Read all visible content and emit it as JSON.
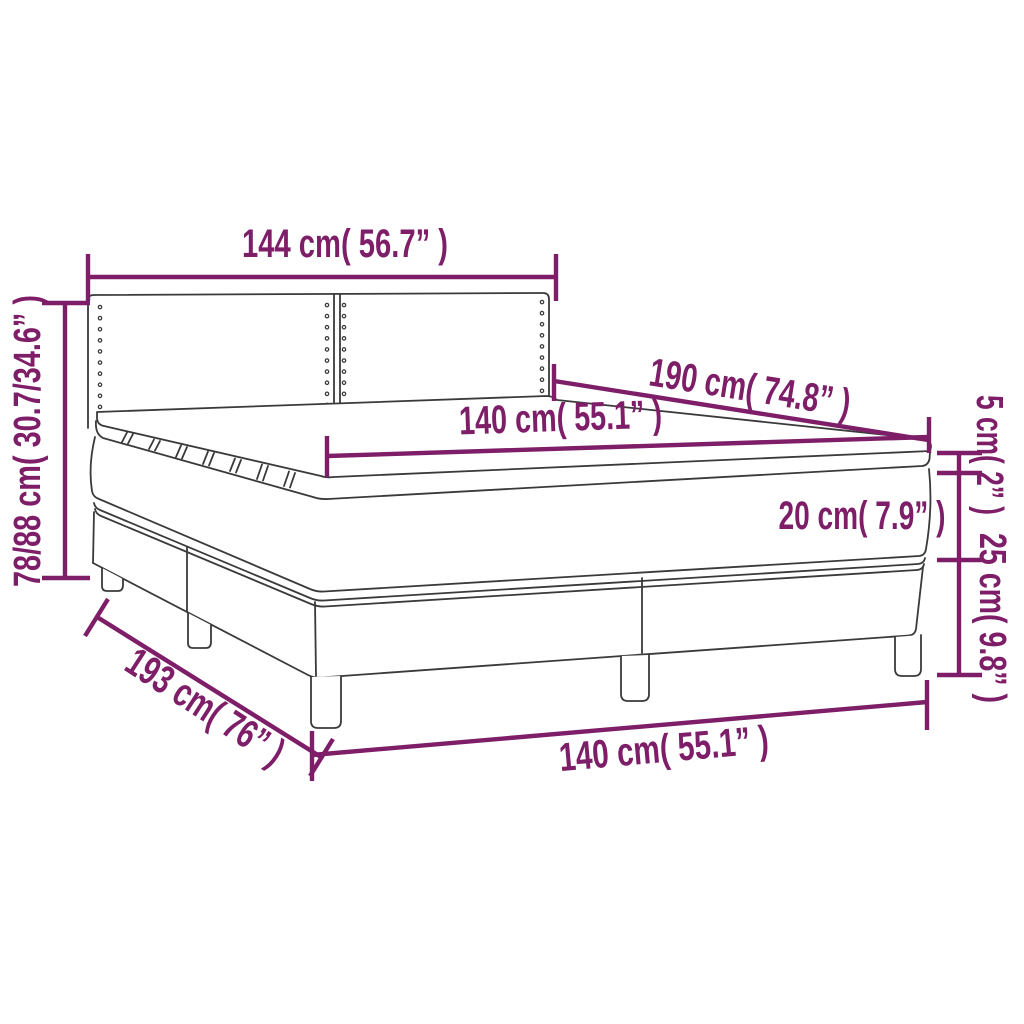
{
  "diagram": {
    "type": "product-dimension-diagram",
    "subject": "box spring bed with upholstered headboard, mattress and topper",
    "colors": {
      "dimension_annotations": "#7e1e68",
      "line_art": "#3a3a3a",
      "background": "#ffffff"
    },
    "labels": {
      "headboard_width": "144 cm( 56.7” )",
      "overall_height": "78/88 cm( 30.7/34.6” )",
      "mattress_length": "190 cm( 74.8” )",
      "mattress_width": "140 cm( 55.1” )",
      "topper_thickness": "5 cm( 2” )",
      "mattress_thickness": "20 cm( 7.9” )",
      "base_height": "25 cm( 9.8” )",
      "base_length": "193 cm( 76” )",
      "base_width": "140 cm( 55.1” )"
    }
  }
}
